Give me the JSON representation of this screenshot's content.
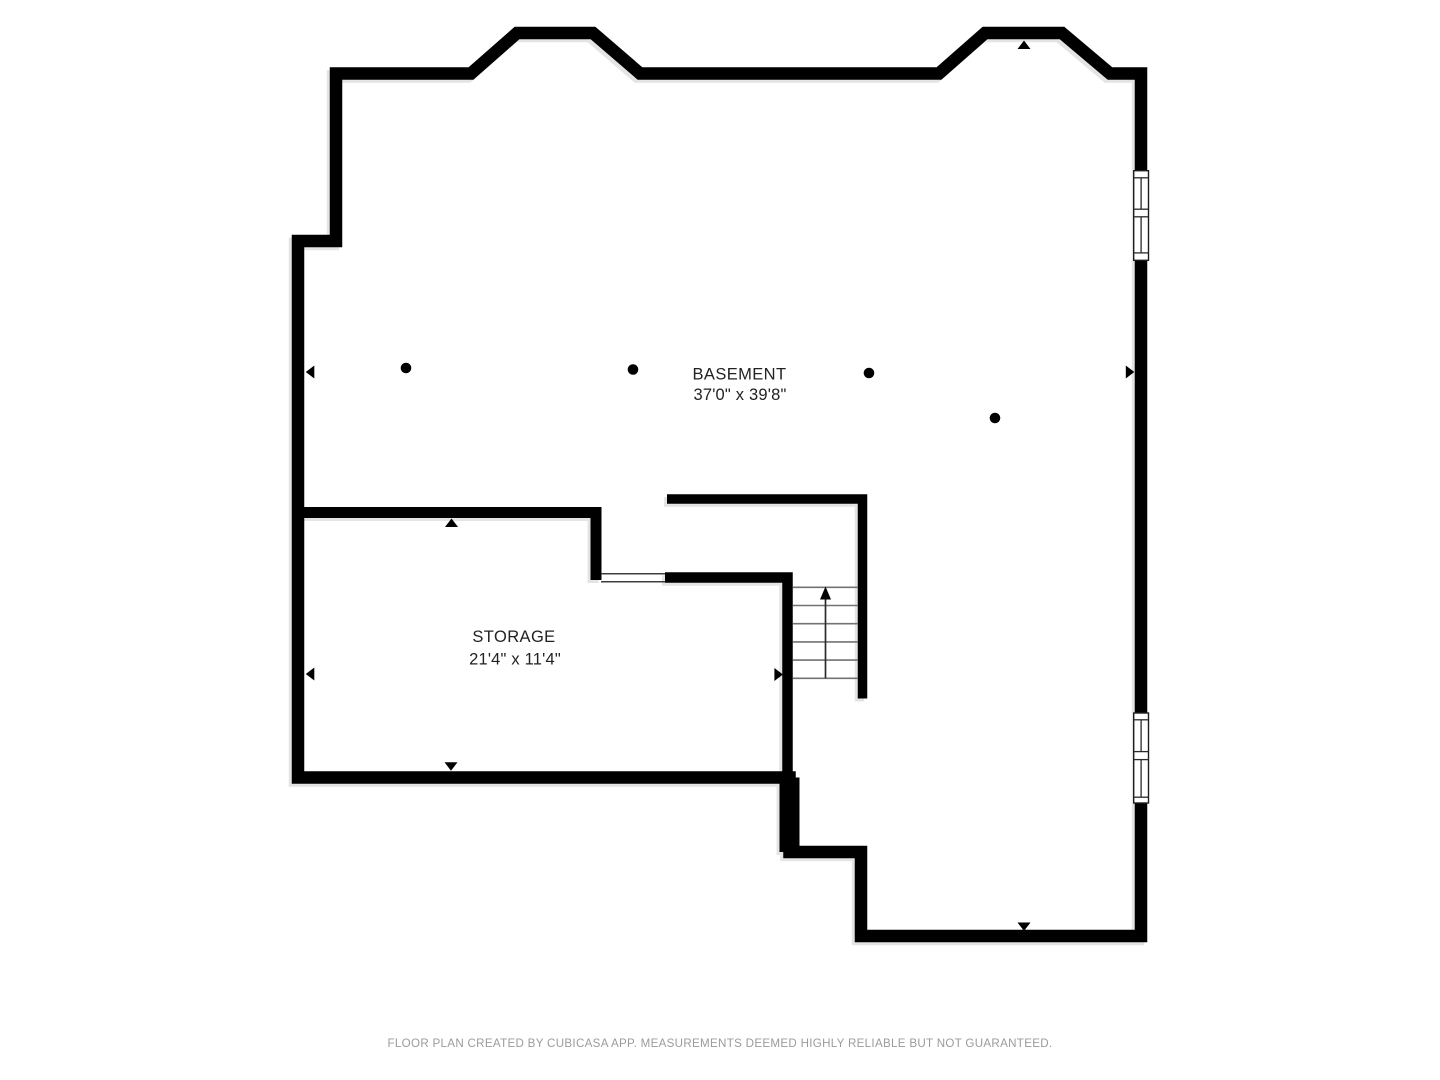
{
  "page": {
    "background_color": "#ffffff"
  },
  "rooms": [
    {
      "name": "BASEMENT",
      "dimensions": "37'0\" x 39'8\""
    },
    {
      "name": "STORAGE",
      "dimensions": "21'4\" x 11'4\""
    }
  ],
  "footer": {
    "disclaimer": "FLOOR PLAN CREATED BY CUBICASA APP. MEASUREMENTS DEEMED HIGHLY RELIABLE BUT NOT GUARANTEED."
  },
  "plan": {
    "features": {
      "window_count": 2,
      "door_openings": 1,
      "stair_treads": 6,
      "stair_direction": "up",
      "support_columns": 4,
      "measure_arrow_count": 8
    },
    "colors": {
      "wall": "#000000",
      "wall_shadow": "#e4e4e4",
      "tread": "#737373",
      "label_text": "#222222",
      "footer_text": "#9b9b9b"
    }
  }
}
